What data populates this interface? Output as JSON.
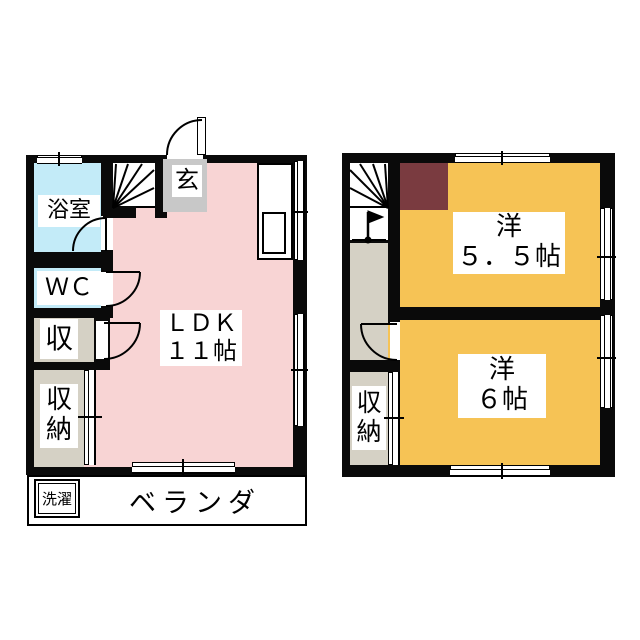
{
  "colors": {
    "wall": "#0a0a0a",
    "ldk_pink": "#f8d4d4",
    "wet_area_blue": "#c3ebf8",
    "closet_beige": "#d5d1c5",
    "entrance_gray": "#c8c8c8",
    "room_orange": "#f6c355",
    "loft_brown": "#7a3b40"
  },
  "floor1": {
    "bathroom": "浴室",
    "wc": "ＷＣ",
    "storage": "収",
    "closet_char1": "収",
    "closet_char2": "納",
    "entrance": "玄",
    "ldk_line1": "ＬＤＫ",
    "ldk_line2": "１１帖",
    "laundry": "洗濯",
    "veranda": "ベランダ"
  },
  "floor2": {
    "room_5_5_line1": "洋",
    "room_5_5_line2": "５．５帖",
    "room_6_line1": "洋",
    "room_6_line2": "６帖",
    "closet_char1": "収",
    "closet_char2": "納"
  }
}
